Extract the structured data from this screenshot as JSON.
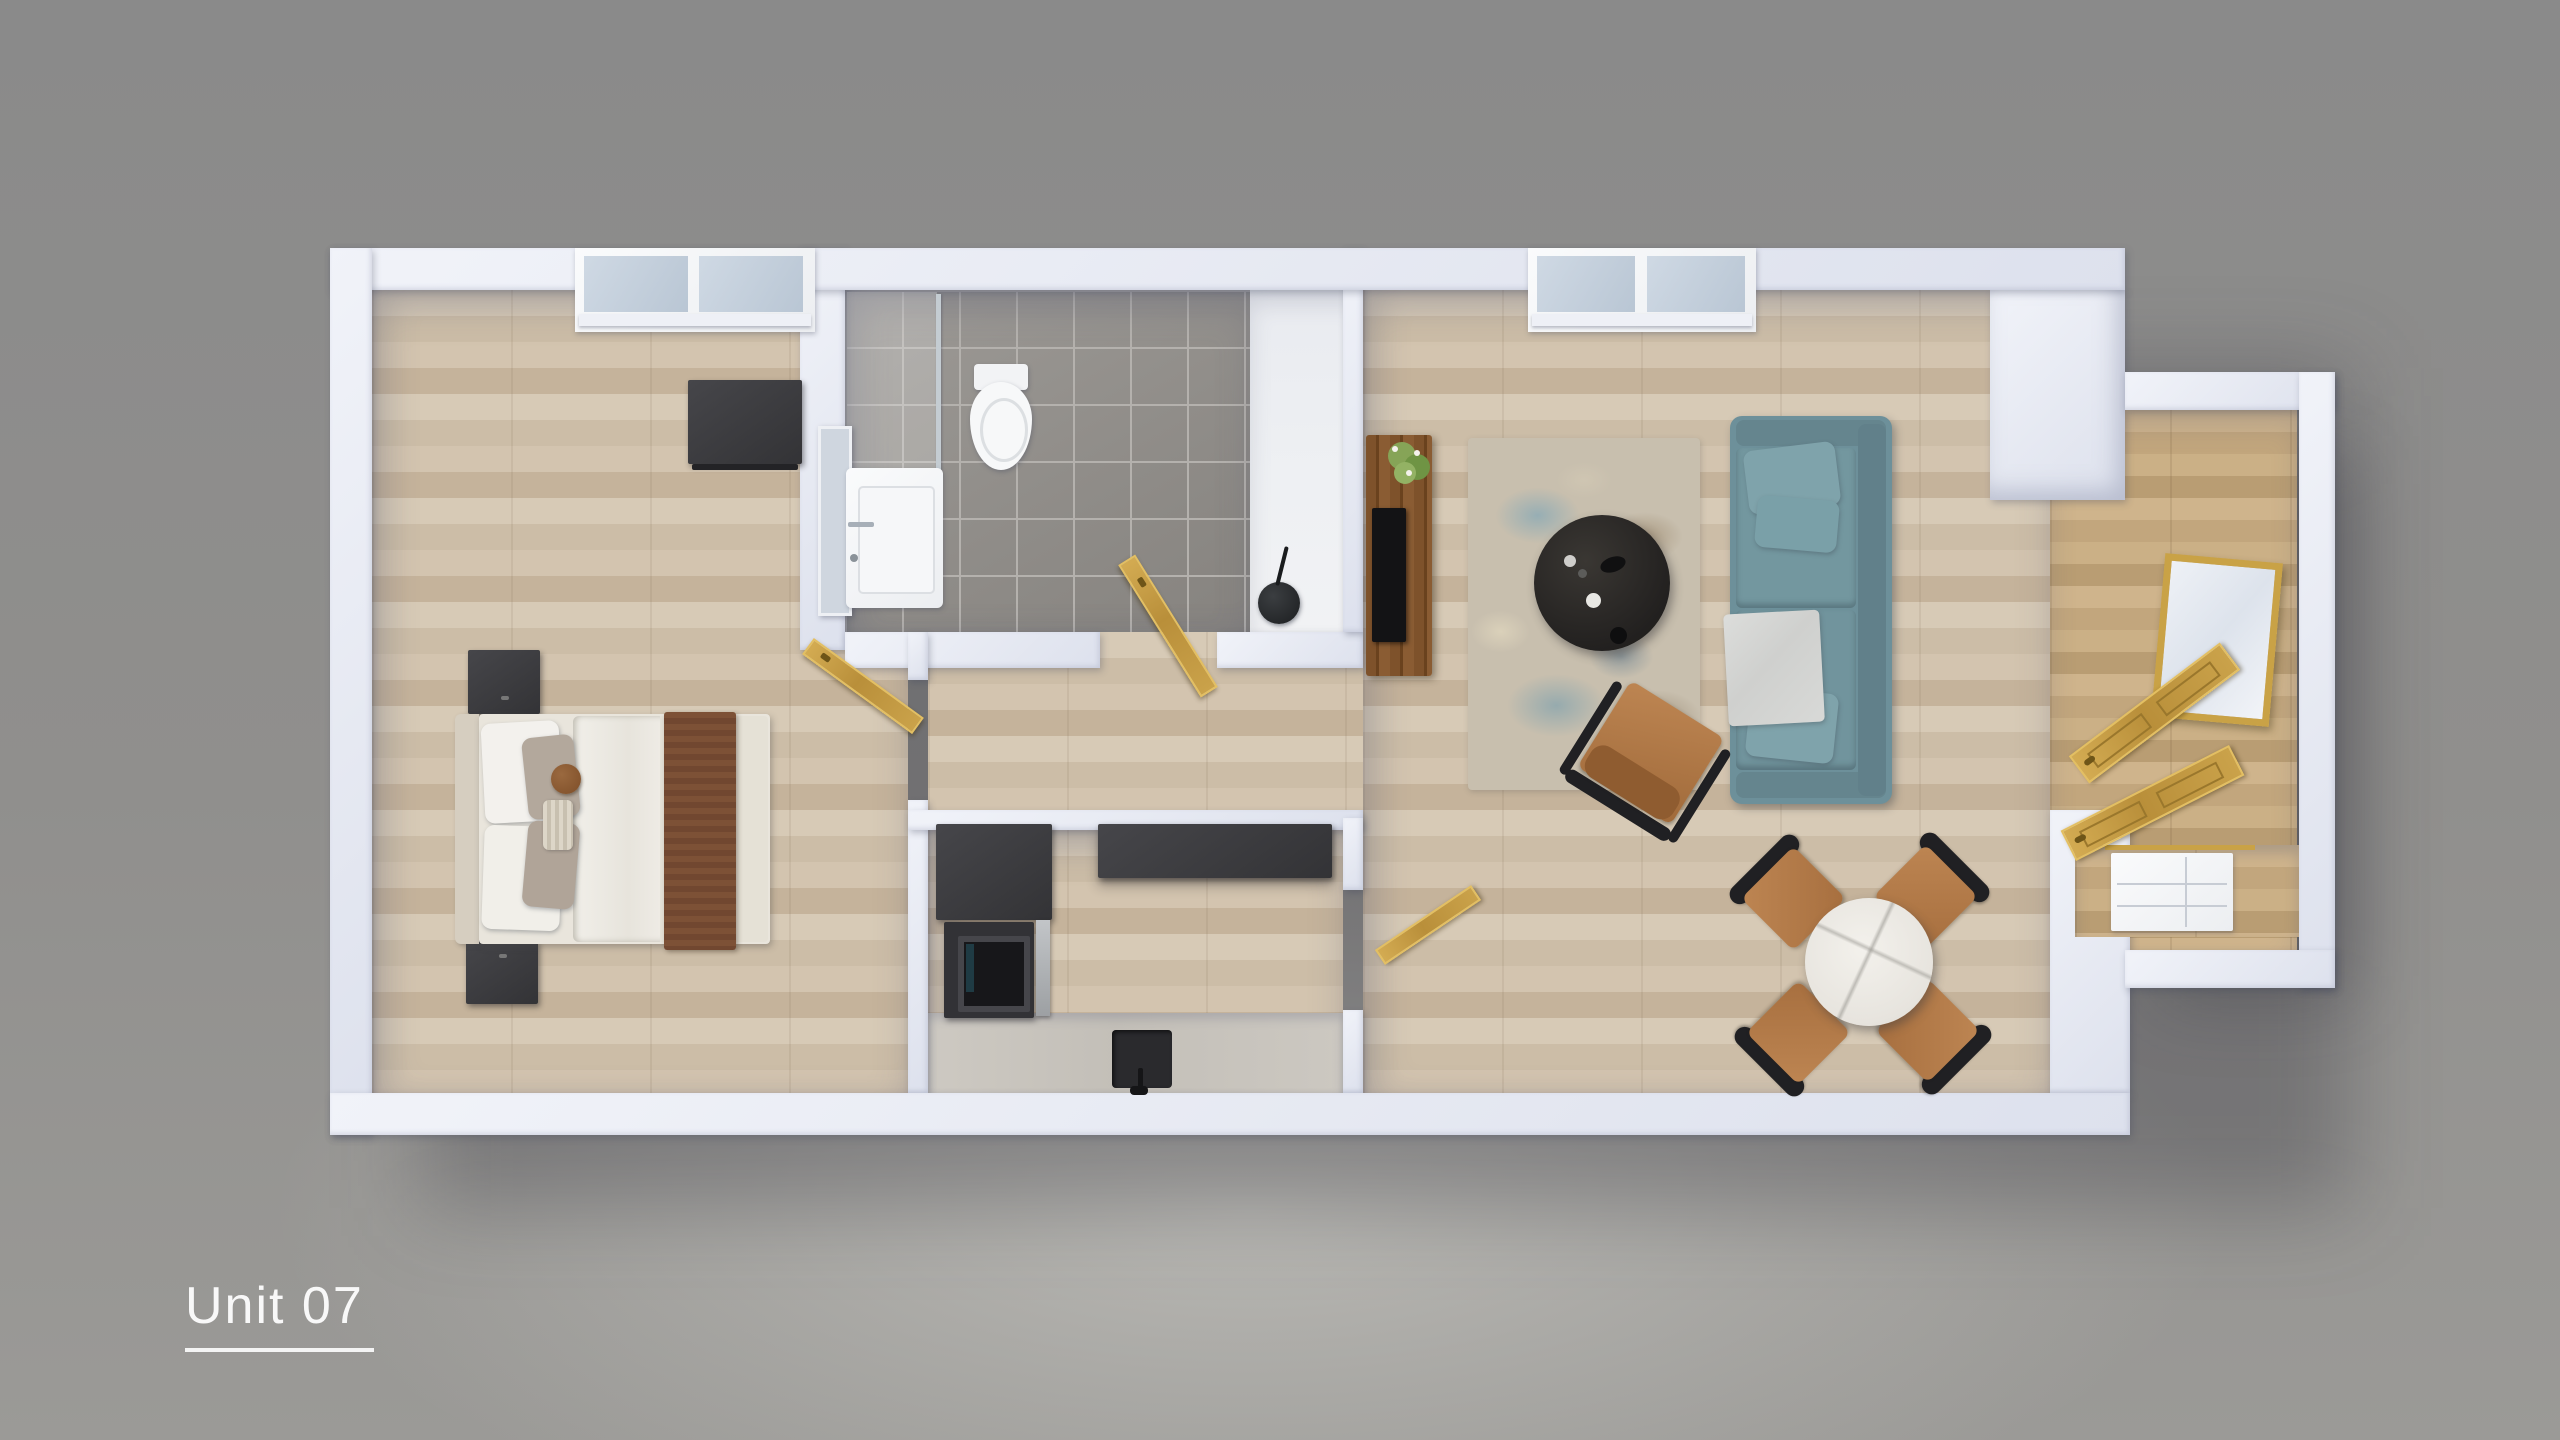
{
  "unit_label": "Unit 07",
  "palette": {
    "background": "#8f8e8c",
    "wall": "#e8ebf3",
    "wood_floor": "#cfc1ab",
    "entry_wood_floor": "#c4aa82",
    "tile_floor": "#94918e",
    "kitchen_counter": "#c9c5be",
    "sofa_teal": "#6f929c",
    "rug_blue_accent": "#7aa3b5",
    "brass_gold": "#c9a246",
    "leather_tan": "#b0794a",
    "dark_furniture": "#3a3a3d",
    "marble_table": "#efede8",
    "label_text": "#f8f8f8"
  },
  "rooms": [
    {
      "name": "bedroom"
    },
    {
      "name": "bathroom"
    },
    {
      "name": "hallway"
    },
    {
      "name": "kitchen"
    },
    {
      "name": "living-dining-room"
    },
    {
      "name": "entry"
    }
  ],
  "furniture": [
    {
      "name": "double-bed"
    },
    {
      "name": "nightstand"
    },
    {
      "name": "dresser"
    },
    {
      "name": "toilet"
    },
    {
      "name": "vanity-sink"
    },
    {
      "name": "bathroom-mirror"
    },
    {
      "name": "shower-glass"
    },
    {
      "name": "utility-basin"
    },
    {
      "name": "fridge"
    },
    {
      "name": "oven"
    },
    {
      "name": "kitchen-wall-shelf"
    },
    {
      "name": "kitchen-counter"
    },
    {
      "name": "kitchen-sink"
    },
    {
      "name": "tv-console"
    },
    {
      "name": "tv"
    },
    {
      "name": "plant"
    },
    {
      "name": "area-rug"
    },
    {
      "name": "round-coffee-table"
    },
    {
      "name": "sofa"
    },
    {
      "name": "lounge-chair"
    },
    {
      "name": "dining-table"
    },
    {
      "name": "dining-chair"
    },
    {
      "name": "sideboard"
    },
    {
      "name": "entry-mirror"
    },
    {
      "name": "entry-door"
    }
  ]
}
